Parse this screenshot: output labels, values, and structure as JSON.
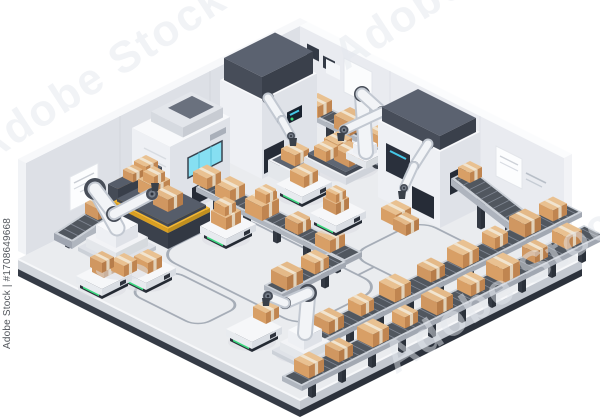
{
  "watermark": {
    "diagonal_text": "Adobe Stock",
    "vertical_label": "Adobe Stock | #1708649668",
    "brand": "Adobe Stock",
    "asset_id": "#1708649668"
  },
  "illustration": {
    "subject": "isometric-automated-warehouse-packaging-line",
    "elements": [
      "robotic-arm",
      "conveyor-belt",
      "cardboard-box",
      "agv-robot",
      "packaging-machine",
      "pallet-station",
      "hazard-sign",
      "wall-control-panel",
      "wall-poster",
      "warehouse-floor"
    ]
  },
  "colors": {
    "background": "#ffffff",
    "floor": "#eaecef",
    "floor_rim_dark": "#353b46",
    "wall_left": "#dde0e6",
    "wall_right": "#e9ebf0",
    "machine_white": "#f6f7fa",
    "dark_gray": "#3a4049",
    "belt_gray": "#51575f",
    "box_tan_top": "#e9c191",
    "box_tan_left": "#d89f66",
    "box_tan_right": "#c08550",
    "tape": "#f1e4cf",
    "hazard_yellow": "#f2b632",
    "screen_cyan": "#86dff2",
    "agv_led_green": "#3bd97f",
    "path_line": "#a6adb7"
  }
}
